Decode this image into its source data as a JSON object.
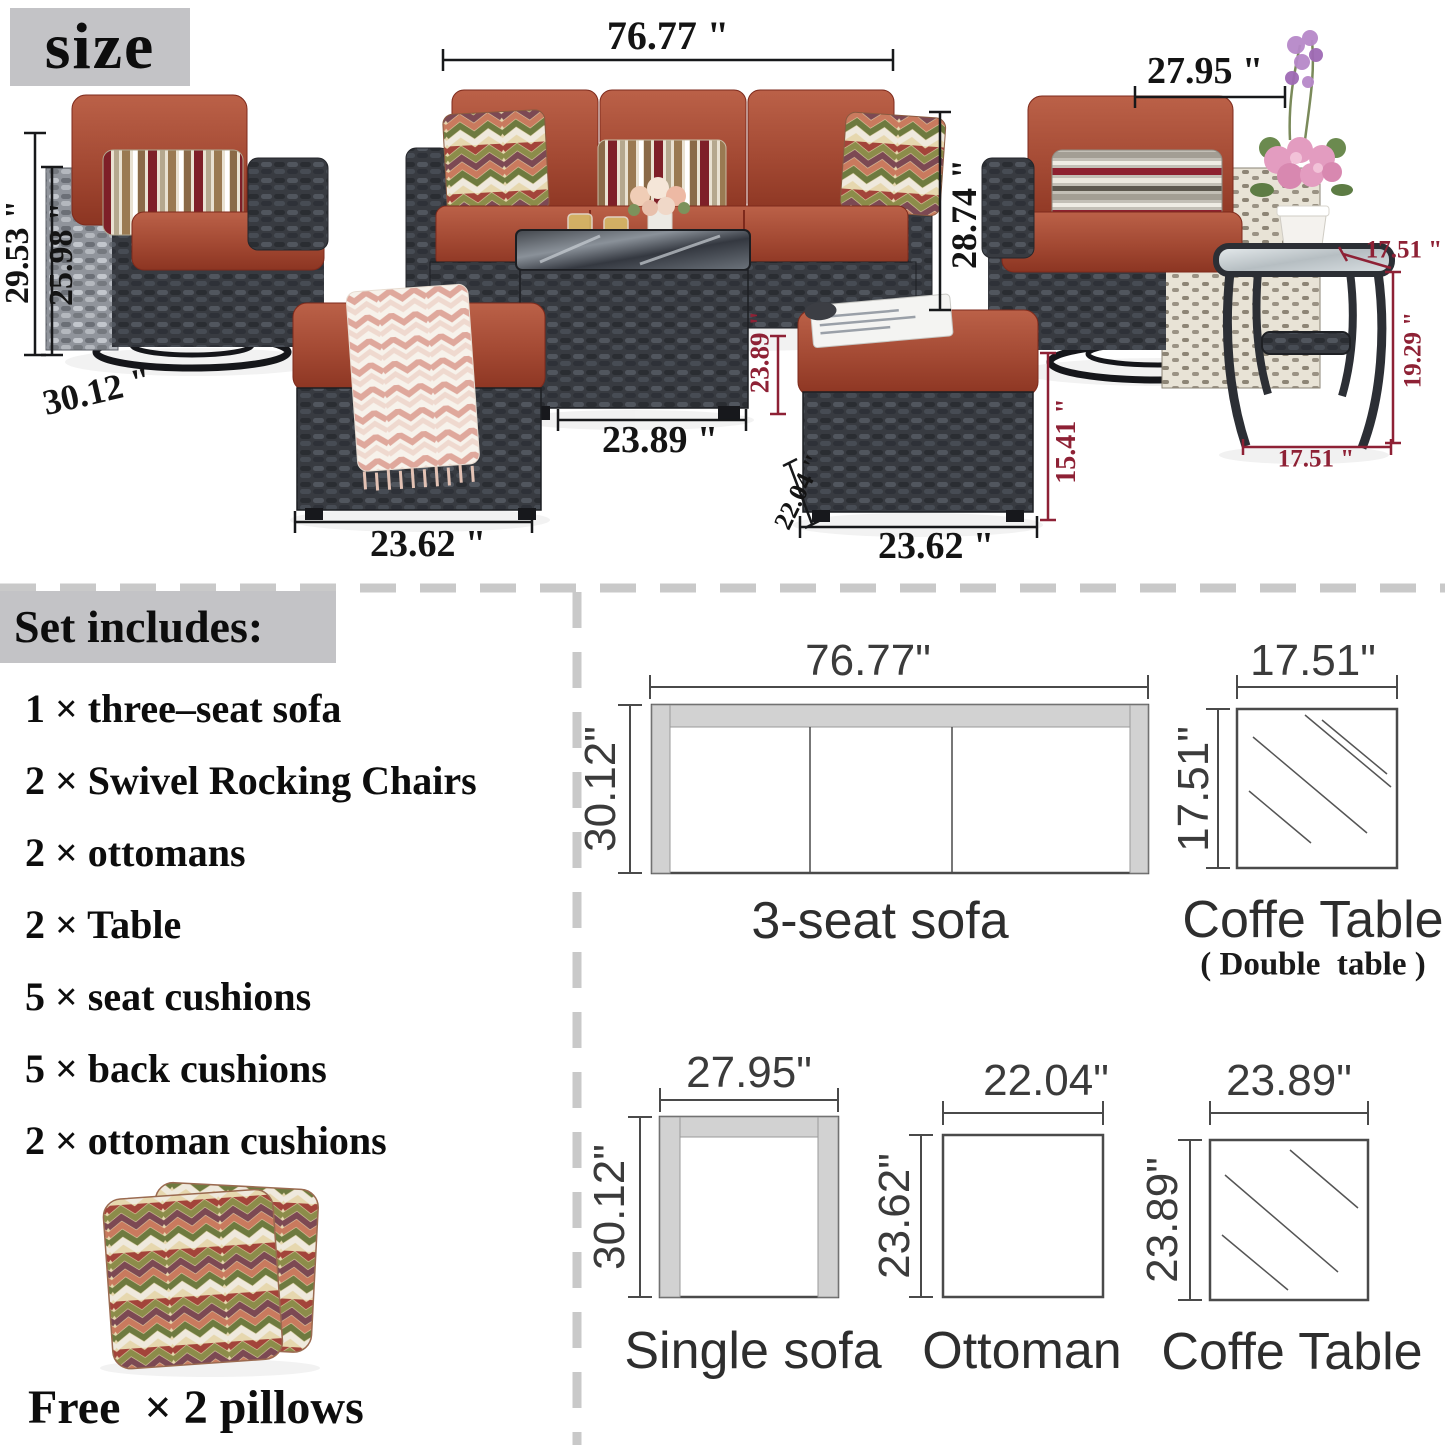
{
  "badge": {
    "size_label": "size"
  },
  "photo": {
    "dims": {
      "sofa_width": "76.77 \"",
      "chair_width": "27.95 \"",
      "chair_total_height": "29.53 \"",
      "chair_frame_height": "25.98 \"",
      "chair_depth": "30.12 \"",
      "sofa_height": "28.74 \"",
      "coffee_height": "23.89 \"",
      "coffee_width": "23.89 \"",
      "ottoman_left_width": "23.62 \"",
      "ottoman_depth": "22.04 \"",
      "ottoman_height": "15.41 \"",
      "ottoman_right_width": "23.62 \"",
      "side_table_top_width": "17.51 \"",
      "side_table_height": "19.29 \"",
      "side_table_width": "17.51 \""
    }
  },
  "includes": {
    "heading": "Set includes:",
    "items": [
      "1 × three–seat sofa",
      "2 × Swivel Rocking Chairs",
      "2 × ottomans",
      "2 × Table",
      "5 × seat cushions",
      "5 × back cushions",
      "2 × ottoman cushions"
    ],
    "free_note": "Free  × 2 pillows"
  },
  "diagrams": {
    "sofa3": {
      "width": "76.77\"",
      "depth": "30.12\"",
      "label": "3-seat sofa"
    },
    "coffee_double": {
      "width": "17.51\"",
      "depth": "17.51\"",
      "label": "Coffe Table",
      "sublabel": "( Double  table )"
    },
    "single_sofa": {
      "width": "27.95\"",
      "depth": "30.12\"",
      "label": "Single sofa"
    },
    "ottoman": {
      "width": "22.04\"",
      "depth": "23.62\"",
      "label": "Ottoman"
    },
    "coffee": {
      "width": "23.89\"",
      "depth": "23.89\"",
      "label": "Coffe Table"
    }
  },
  "colors": {
    "accent_maroon": "#8e2135",
    "cushion_rust": "#a34933",
    "heading_gray": "#c3c3c6",
    "dash_gray": "#c9c9c9"
  }
}
